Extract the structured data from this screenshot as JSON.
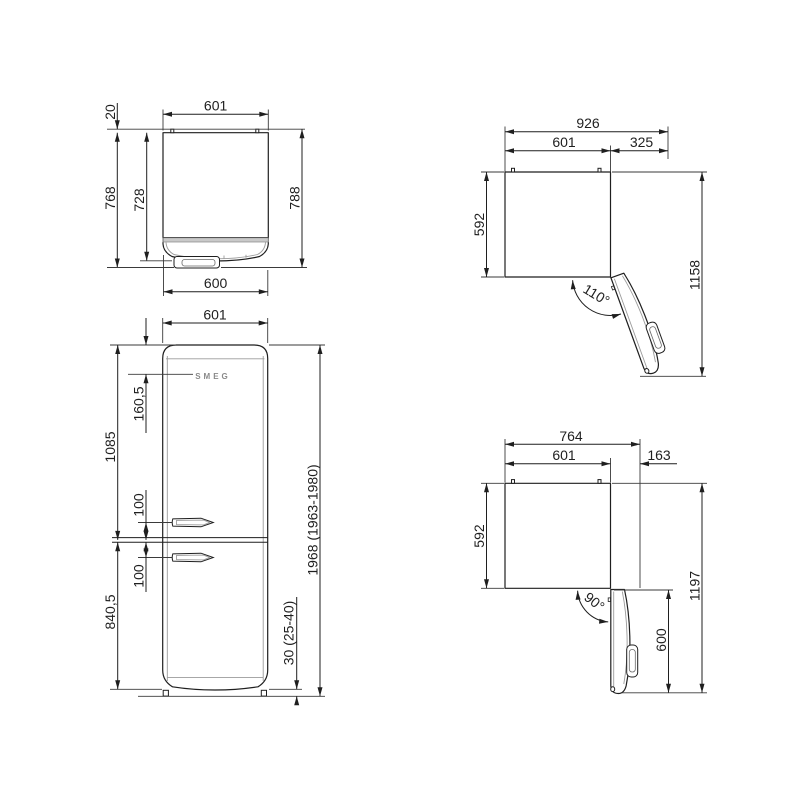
{
  "colors": {
    "ink": "#1f1f1f",
    "light_line": "#9b9b9b",
    "band": "#c9c9c9",
    "logo_gray": "#8a8a8a"
  },
  "views": {
    "top_closed": {
      "width": "601",
      "rear_spacer": "20",
      "depth_with_door": "768",
      "depth_body": "728",
      "depth_total": "788",
      "door_width": "600"
    },
    "door_110": {
      "overall_width": "926",
      "body_width": "601",
      "door_projection": "325",
      "depth": "592",
      "overall_depth": "1158",
      "opening_angle": "110°"
    },
    "front": {
      "width": "601",
      "brand": "SMEG",
      "control_offset": "160,5",
      "fridge_section_height": "1085",
      "upper_handle_gap": "100",
      "lower_handle_gap": "100",
      "freezer_section_height": "840,5",
      "total_height": "1968 (1963-1980)",
      "feet_height": "30 (25-40)"
    },
    "door_90": {
      "overall_width": "764",
      "body_width": "601",
      "door_projection": "163",
      "depth": "592",
      "overall_depth": "1197",
      "door_length": "600",
      "opening_angle": "90°"
    }
  }
}
